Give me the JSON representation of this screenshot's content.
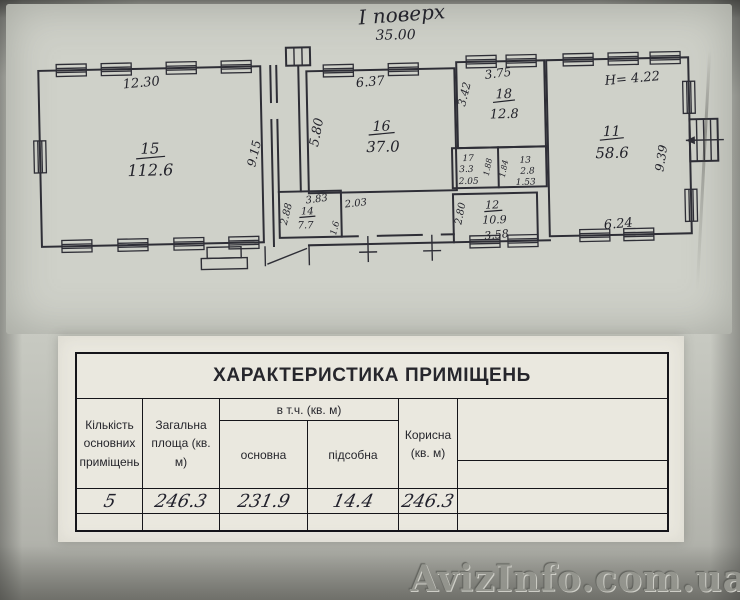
{
  "plan": {
    "floor_title": "І поверх",
    "overall_width": "35.00",
    "rooms": {
      "r15": {
        "number": "15",
        "area": "112.6",
        "dim_top": "12.30",
        "dim_side": "9.15"
      },
      "r16": {
        "number": "16",
        "area": "37.0",
        "dim_top": "6.37",
        "dim_side": "5.80"
      },
      "r18": {
        "number": "18",
        "area": "12.8",
        "dim_top": "3.75",
        "dim_side": "3.42"
      },
      "r17": {
        "number": "17",
        "area": "3.3",
        "dim_bottom": "2.05",
        "dim_side": "1.88"
      },
      "r13": {
        "number": "13",
        "area": "2.8",
        "dim_bottom": "1.53",
        "dim_side": "1.84"
      },
      "r14": {
        "number": "14",
        "area": "7.7",
        "dim_top": "3.83",
        "dim_left": "2.88",
        "dim_right": "2.03",
        "dim_bottom": "1.6"
      },
      "r12": {
        "number": "12",
        "area": "10.9",
        "dim_bottom": "3.58",
        "dim_left": "2.80"
      },
      "r11": {
        "number": "11",
        "area": "58.6",
        "height_note": "Н= 4.22",
        "dim_side": "9.39",
        "dim_bottom": "6.24"
      }
    }
  },
  "table": {
    "title": "ХАРАКТЕРИСТИКА ПРИМІЩЕНЬ",
    "group_header": "в т.ч. (кв. м)",
    "col_count": "Кількість основних приміщень",
    "col_total": "Загальна площа (кв. м)",
    "col_main": "основна",
    "col_aux": "підсобна",
    "col_useful": "Корисна (кв. м)",
    "row": {
      "count": "5",
      "total": "246.3",
      "main": "231.9",
      "aux": "14.4",
      "useful": "246.3"
    }
  },
  "watermark": "AvizInfo.com.ua"
}
